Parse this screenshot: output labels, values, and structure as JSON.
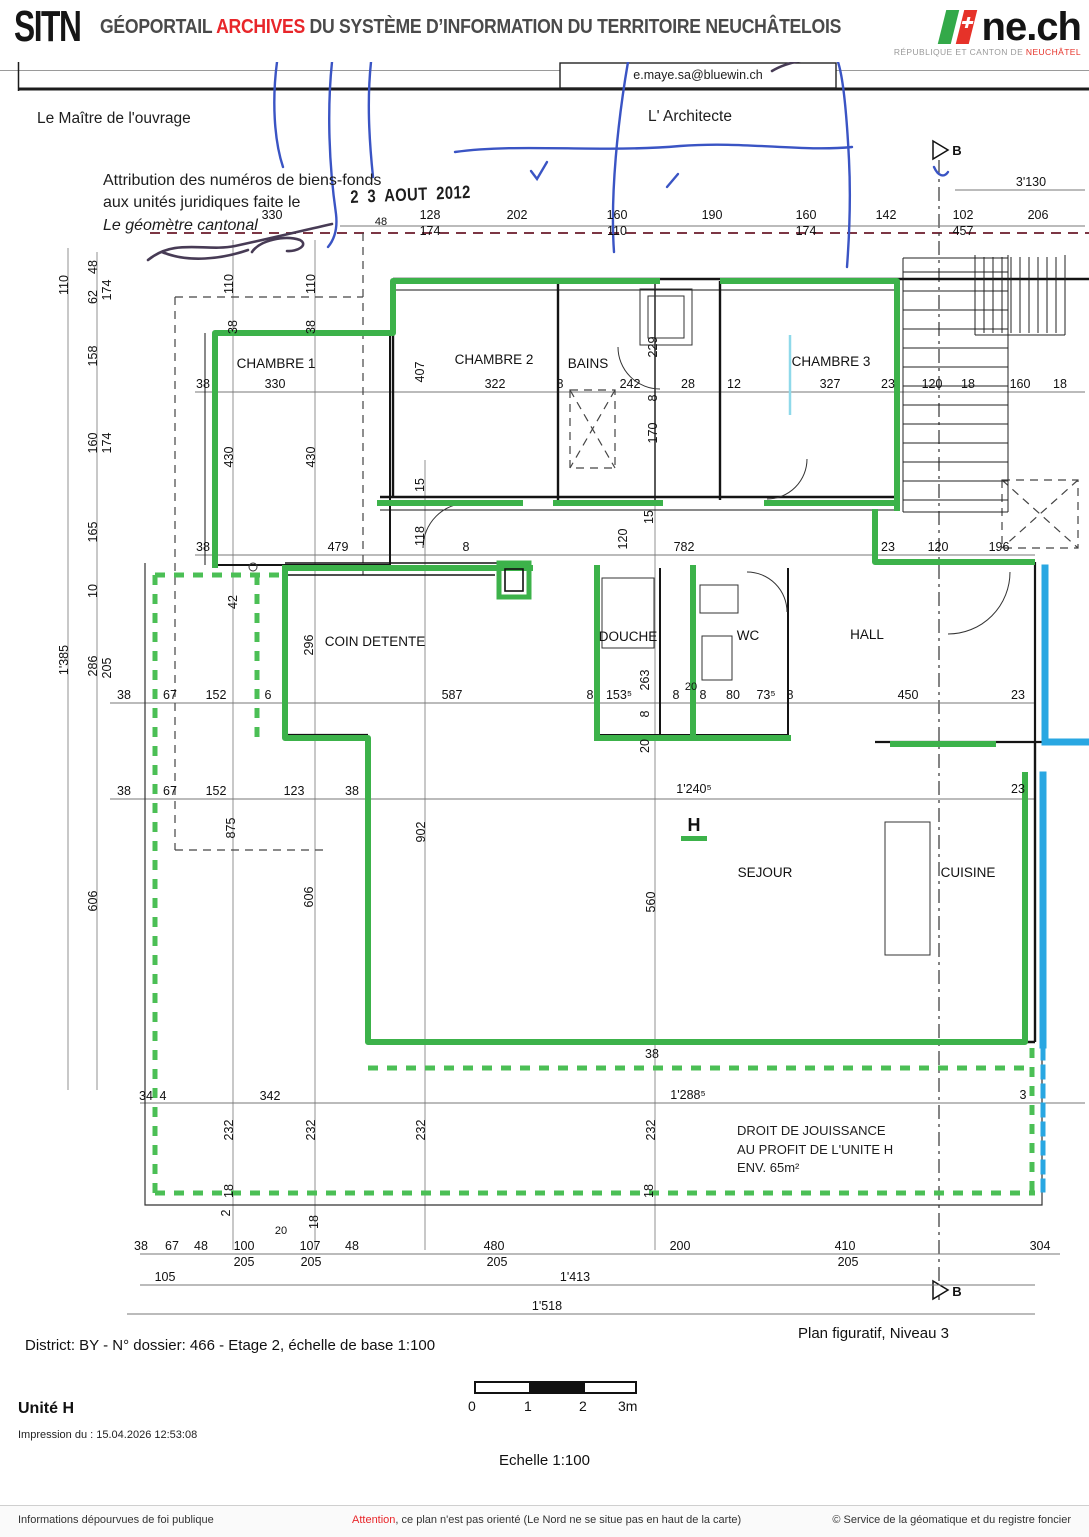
{
  "header": {
    "logo": "SITN",
    "title_pre": "GÉOPORTAIL ",
    "title_red": "ARCHIVES",
    "title_post": " DU SYSTÈME D’INFORMATION DU TERRITOIRE NEUCHÂTELOIS",
    "nech": "ne.ch",
    "nech_sub_pre": "RÉPUBLIQUE ET CANTON DE ",
    "nech_sub_red": "NEUCHÂTEL"
  },
  "document": {
    "email": "e.maye.sa@bluewin.ch",
    "owner_label": "Le Maître de l'ouvrage",
    "architect_label": "L' Architecte",
    "attribution": {
      "line1": "Attribution des numéros de biens-fonds",
      "line2": "aux unités juridiques faite le",
      "stamp": "2 3 AOUT 2012",
      "line3": "Le géomètre cantonal"
    },
    "jouissance": {
      "line1": "DROIT DE JOUISSANCE",
      "line2": "AU PROFIT DE L'UNITE H",
      "line3": "ENV. 65m²"
    },
    "unit_letter": "H",
    "colors": {
      "unit_h_green": "#3cb24a",
      "other_unit_blue": "#29a7e2",
      "pen_blue": "#3a54c4"
    },
    "rooms": [
      {
        "t": "CHAMBRE 1",
        "x": 276,
        "y": 368
      },
      {
        "t": "CHAMBRE 2",
        "x": 494,
        "y": 364
      },
      {
        "t": "BAINS",
        "x": 588,
        "y": 368
      },
      {
        "t": "CHAMBRE 3",
        "x": 831,
        "y": 366
      },
      {
        "t": "COIN DETENTE",
        "x": 375,
        "y": 646
      },
      {
        "t": "DOUCHE",
        "x": 628,
        "y": 641
      },
      {
        "t": "WC",
        "x": 748,
        "y": 640
      },
      {
        "t": "HALL",
        "x": 867,
        "y": 639
      },
      {
        "t": "SEJOUR",
        "x": 765,
        "y": 877
      },
      {
        "t": "CUISINE",
        "x": 968,
        "y": 877
      }
    ],
    "dim_labels": [
      {
        "t": "3'130",
        "x": 1031,
        "y": 186
      },
      {
        "t": "330",
        "x": 272,
        "y": 219
      },
      {
        "t": "48",
        "x": 381,
        "y": 225,
        "s": 11
      },
      {
        "t": "128",
        "x": 430,
        "y": 219
      },
      {
        "t": "202",
        "x": 517,
        "y": 219
      },
      {
        "t": "160",
        "x": 617,
        "y": 219
      },
      {
        "t": "190",
        "x": 712,
        "y": 219
      },
      {
        "t": "160",
        "x": 806,
        "y": 219
      },
      {
        "t": "142",
        "x": 886,
        "y": 219
      },
      {
        "t": "102",
        "x": 963,
        "y": 219
      },
      {
        "t": "206",
        "x": 1038,
        "y": 219
      },
      {
        "t": "174",
        "x": 430,
        "y": 235
      },
      {
        "t": "110",
        "x": 617,
        "y": 235
      },
      {
        "t": "174",
        "x": 806,
        "y": 235
      },
      {
        "t": "457",
        "x": 963,
        "y": 235
      },
      {
        "t": "110",
        "x": 68,
        "y": 285,
        "v": 1
      },
      {
        "t": "48",
        "x": 97,
        "y": 267,
        "v": 1
      },
      {
        "t": "62",
        "x": 97,
        "y": 297,
        "v": 1
      },
      {
        "t": "174",
        "x": 111,
        "y": 290,
        "v": 1
      },
      {
        "t": "158",
        "x": 97,
        "y": 356,
        "v": 1
      },
      {
        "t": "160",
        "x": 97,
        "y": 443,
        "v": 1
      },
      {
        "t": "174",
        "x": 111,
        "y": 443,
        "v": 1
      },
      {
        "t": "165",
        "x": 97,
        "y": 532,
        "v": 1
      },
      {
        "t": "10",
        "x": 97,
        "y": 591,
        "v": 1
      },
      {
        "t": "286",
        "x": 97,
        "y": 666,
        "v": 1
      },
      {
        "t": "205",
        "x": 111,
        "y": 668,
        "v": 1
      },
      {
        "t": "1'385",
        "x": 68,
        "y": 660,
        "v": 1
      },
      {
        "t": "606",
        "x": 97,
        "y": 901,
        "v": 1
      },
      {
        "t": "110",
        "x": 233,
        "y": 284,
        "v": 1
      },
      {
        "t": "110",
        "x": 315,
        "y": 284,
        "v": 1
      },
      {
        "t": "38",
        "x": 237,
        "y": 327,
        "v": 1
      },
      {
        "t": "38",
        "x": 315,
        "y": 327,
        "v": 1
      },
      {
        "t": "430",
        "x": 233,
        "y": 457,
        "v": 1
      },
      {
        "t": "430",
        "x": 315,
        "y": 457,
        "v": 1
      },
      {
        "t": "407",
        "x": 424,
        "y": 372,
        "v": 1
      },
      {
        "t": "15",
        "x": 424,
        "y": 485,
        "v": 1
      },
      {
        "t": "229",
        "x": 657,
        "y": 347,
        "v": 1
      },
      {
        "t": "8",
        "x": 657,
        "y": 398,
        "v": 1
      },
      {
        "t": "170",
        "x": 657,
        "y": 433,
        "v": 1
      },
      {
        "t": "38",
        "x": 203,
        "y": 388
      },
      {
        "t": "330",
        "x": 275,
        "y": 388
      },
      {
        "t": "322",
        "x": 495,
        "y": 388
      },
      {
        "t": "8",
        "x": 560,
        "y": 388
      },
      {
        "t": "242",
        "x": 630,
        "y": 388
      },
      {
        "t": "28",
        "x": 688,
        "y": 388
      },
      {
        "t": "12",
        "x": 734,
        "y": 388
      },
      {
        "t": "327",
        "x": 830,
        "y": 388
      },
      {
        "t": "23",
        "x": 888,
        "y": 388
      },
      {
        "t": "120",
        "x": 932,
        "y": 388
      },
      {
        "t": "18",
        "x": 968,
        "y": 388
      },
      {
        "t": "160",
        "x": 1020,
        "y": 388
      },
      {
        "t": "18",
        "x": 1060,
        "y": 388
      },
      {
        "t": "38",
        "x": 203,
        "y": 551
      },
      {
        "t": "479",
        "x": 338,
        "y": 551
      },
      {
        "t": "8",
        "x": 466,
        "y": 551
      },
      {
        "t": "782",
        "x": 684,
        "y": 551
      },
      {
        "t": "23",
        "x": 888,
        "y": 551
      },
      {
        "t": "120",
        "x": 938,
        "y": 551
      },
      {
        "t": "196",
        "x": 999,
        "y": 551
      },
      {
        "t": "118",
        "x": 424,
        "y": 536,
        "v": 1
      },
      {
        "t": "120",
        "x": 627,
        "y": 539,
        "v": 1
      },
      {
        "t": "15",
        "x": 653,
        "y": 517,
        "v": 1
      },
      {
        "t": "42",
        "x": 237,
        "y": 602,
        "v": 1
      },
      {
        "t": "296",
        "x": 313,
        "y": 645,
        "v": 1
      },
      {
        "t": "38",
        "x": 124,
        "y": 699
      },
      {
        "t": "67",
        "x": 170,
        "y": 699
      },
      {
        "t": "152",
        "x": 216,
        "y": 699
      },
      {
        "t": "6",
        "x": 268,
        "y": 699
      },
      {
        "t": "587",
        "x": 452,
        "y": 699
      },
      {
        "t": "8",
        "x": 590,
        "y": 699
      },
      {
        "t": "153⁵",
        "x": 619,
        "y": 699
      },
      {
        "t": "8",
        "x": 676,
        "y": 699
      },
      {
        "t": "20",
        "x": 691,
        "y": 690,
        "s": 11
      },
      {
        "t": "8",
        "x": 703,
        "y": 699
      },
      {
        "t": "80",
        "x": 733,
        "y": 699
      },
      {
        "t": "73⁵",
        "x": 766,
        "y": 699
      },
      {
        "t": "8",
        "x": 790,
        "y": 699
      },
      {
        "t": "450",
        "x": 908,
        "y": 699
      },
      {
        "t": "23",
        "x": 1018,
        "y": 699
      },
      {
        "t": "263",
        "x": 649,
        "y": 680,
        "v": 1
      },
      {
        "t": "8",
        "x": 649,
        "y": 714,
        "v": 1
      },
      {
        "t": "20",
        "x": 649,
        "y": 746,
        "v": 1
      },
      {
        "t": "38",
        "x": 124,
        "y": 795
      },
      {
        "t": "67",
        "x": 170,
        "y": 795
      },
      {
        "t": "152",
        "x": 216,
        "y": 795
      },
      {
        "t": "123",
        "x": 294,
        "y": 795
      },
      {
        "t": "38",
        "x": 352,
        "y": 795
      },
      {
        "t": "1'240⁵",
        "x": 694,
        "y": 793
      },
      {
        "t": "23",
        "x": 1018,
        "y": 793
      },
      {
        "t": "875",
        "x": 235,
        "y": 828,
        "v": 1
      },
      {
        "t": "606",
        "x": 313,
        "y": 897,
        "v": 1
      },
      {
        "t": "902",
        "x": 425,
        "y": 832,
        "v": 1
      },
      {
        "t": "560",
        "x": 655,
        "y": 902,
        "v": 1
      },
      {
        "t": "H",
        "x": 694,
        "y": 831,
        "s": 18,
        "b": 1
      },
      {
        "t": "38",
        "x": 652,
        "y": 1058
      },
      {
        "t": "34",
        "x": 146,
        "y": 1100
      },
      {
        "t": "4",
        "x": 163,
        "y": 1100
      },
      {
        "t": "342",
        "x": 270,
        "y": 1100
      },
      {
        "t": "1'288⁵",
        "x": 688,
        "y": 1099
      },
      {
        "t": "3",
        "x": 1023,
        "y": 1099
      },
      {
        "t": "232",
        "x": 233,
        "y": 1130,
        "v": 1
      },
      {
        "t": "232",
        "x": 315,
        "y": 1130,
        "v": 1
      },
      {
        "t": "232",
        "x": 425,
        "y": 1130,
        "v": 1
      },
      {
        "t": "232",
        "x": 655,
        "y": 1130,
        "v": 1
      },
      {
        "t": "18",
        "x": 233,
        "y": 1191,
        "v": 1
      },
      {
        "t": "2",
        "x": 230,
        "y": 1213,
        "v": 1
      },
      {
        "t": "18",
        "x": 318,
        "y": 1222,
        "v": 1
      },
      {
        "t": "20",
        "x": 281,
        "y": 1234,
        "s": 11
      },
      {
        "t": "18",
        "x": 653,
        "y": 1191,
        "v": 1
      },
      {
        "t": "38",
        "x": 141,
        "y": 1250
      },
      {
        "t": "67",
        "x": 172,
        "y": 1250
      },
      {
        "t": "48",
        "x": 201,
        "y": 1250
      },
      {
        "t": "100",
        "x": 244,
        "y": 1250
      },
      {
        "t": "107",
        "x": 310,
        "y": 1250
      },
      {
        "t": "48",
        "x": 352,
        "y": 1250
      },
      {
        "t": "480",
        "x": 494,
        "y": 1250
      },
      {
        "t": "200",
        "x": 680,
        "y": 1250
      },
      {
        "t": "410",
        "x": 845,
        "y": 1250
      },
      {
        "t": "304",
        "x": 1040,
        "y": 1250
      },
      {
        "t": "205",
        "x": 244,
        "y": 1266
      },
      {
        "t": "205",
        "x": 311,
        "y": 1266
      },
      {
        "t": "205",
        "x": 497,
        "y": 1266
      },
      {
        "t": "205",
        "x": 848,
        "y": 1266
      },
      {
        "t": "105",
        "x": 165,
        "y": 1281
      },
      {
        "t": "1'413",
        "x": 575,
        "y": 1281
      },
      {
        "t": "1'518",
        "x": 547,
        "y": 1310
      },
      {
        "t": "B",
        "x": 957,
        "y": 155,
        "s": 13,
        "b": 1
      },
      {
        "t": "B",
        "x": 957,
        "y": 1296,
        "s": 13,
        "b": 1
      }
    ]
  },
  "footer": {
    "district_line": "District: BY - N° dossier: 466 - Etage 2, échelle de base 1:100",
    "plan_caption": "Plan figuratif, Niveau 3",
    "unit_label": "Unité H",
    "impression": "Impression du : 15.04.2026 12:53:08",
    "scale_label": "Echelle 1:100",
    "scalebar_ticks": [
      "0",
      "1",
      "2",
      "3m"
    ],
    "legal_left": "Informations dépourvues de foi publique",
    "legal_attention": "Attention",
    "legal_center_rest": ", ce plan n'est pas orienté (Le Nord ne se situe pas en haut de la carte)",
    "legal_right": "© Service de la géomatique et du registre foncier"
  }
}
